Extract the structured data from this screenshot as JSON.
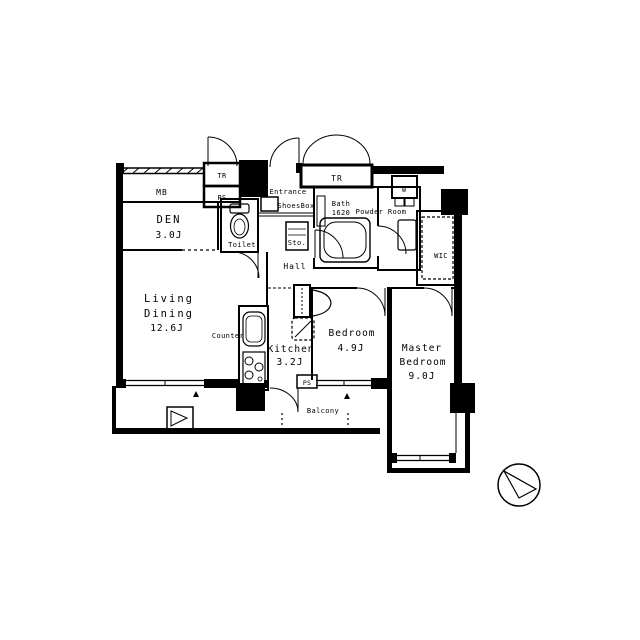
{
  "document": {
    "type": "apartment-floor-plan",
    "background_color": "#ffffff",
    "line_color": "#000000"
  },
  "labels": {
    "mb": "MB",
    "tr_left": "TR",
    "ps_upper": "PS",
    "den_name": "DEN",
    "den_size": "3.0J",
    "toilet": "Toilet",
    "entrance": "Entrance",
    "shoes_box": "ShoesBox",
    "storage": "Sto.",
    "tr_top": "TR",
    "bath_name": "Bath",
    "bath_size": "1620",
    "washer": "W",
    "powder_room": "Powder Room",
    "hall": "Hall",
    "wic": "WIC",
    "living_line1": "Living",
    "living_line2": "Dining",
    "living_size": "12.6J",
    "counter": "Counter",
    "kitchen_name": "Kitchen",
    "kitchen_size": "3.2J",
    "bedroom_name": "Bedroom",
    "bedroom_size": "4.9J",
    "master_line1": "Master",
    "master_line2": "Bedroom",
    "master_size": "9.0J",
    "ps_lower": "PS",
    "balcony": "Balcony"
  },
  "compass": {
    "type": "north-arrow"
  }
}
